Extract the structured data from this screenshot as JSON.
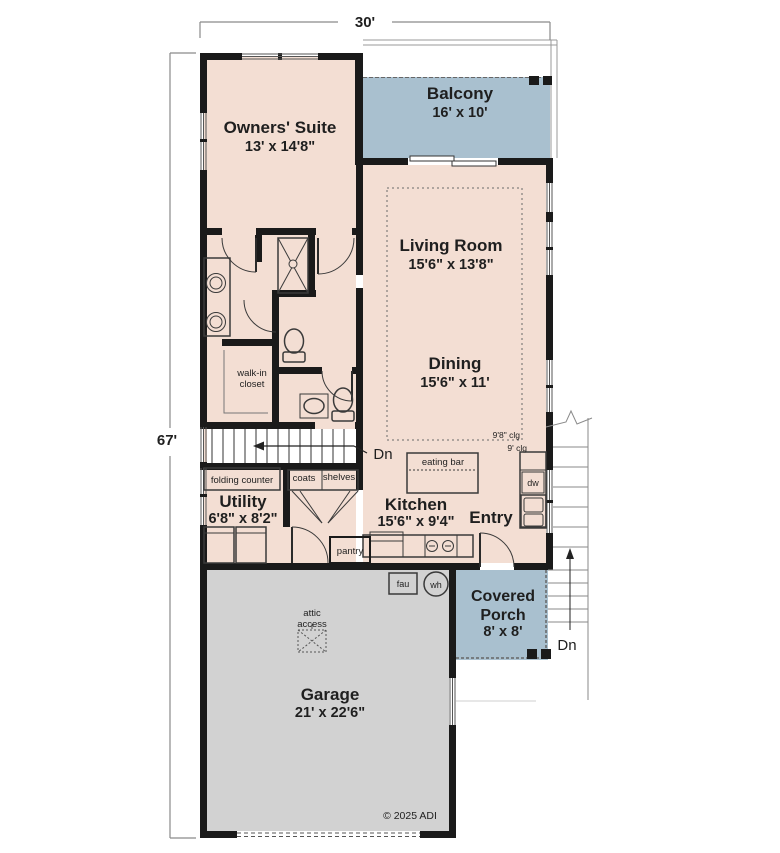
{
  "dimensions": {
    "width": "30'",
    "height": "67'"
  },
  "rooms": {
    "owners_suite": {
      "name": "Owners' Suite",
      "size": "13' x 14'8\""
    },
    "balcony": {
      "name": "Balcony",
      "size": "16' x 10'"
    },
    "living_room": {
      "name": "Living Room",
      "size": "15'6\" x 13'8\""
    },
    "dining": {
      "name": "Dining",
      "size": "15'6\" x 11'"
    },
    "kitchen": {
      "name": "Kitchen",
      "size": "15'6\" x 9'4\""
    },
    "entry": {
      "name": "Entry"
    },
    "utility": {
      "name": "Utility",
      "size": "6'8\" x 8'2\""
    },
    "covered_porch": {
      "name_line1": "Covered",
      "name_line2": "Porch",
      "size": "8' x 8'"
    },
    "garage": {
      "name": "Garage",
      "size": "21' x 22'6\""
    }
  },
  "features": {
    "walk_in_closet_line1": "walk-in",
    "walk_in_closet_line2": "closet",
    "folding_counter": "folding counter",
    "coats": "coats",
    "shelves": "shelves",
    "eating_bar": "eating bar",
    "pantry": "pantry",
    "dishwasher": "dw",
    "furnace": "fau",
    "water_heater": "wh",
    "attic_access_line1": "attic",
    "attic_access_line2": "access",
    "ceiling_high": "9'8\" clg",
    "ceiling_low": "9' clg",
    "stairs_down_interior": "Dn",
    "stairs_down_exterior": "Dn"
  },
  "title_block": {
    "copyright": "© 2025 ADI"
  },
  "colors": {
    "floor": "#f3ded3",
    "outdoor": "#a9c0cf",
    "garage_floor": "#d2d2d2",
    "wall": "#1a1a1a"
  }
}
